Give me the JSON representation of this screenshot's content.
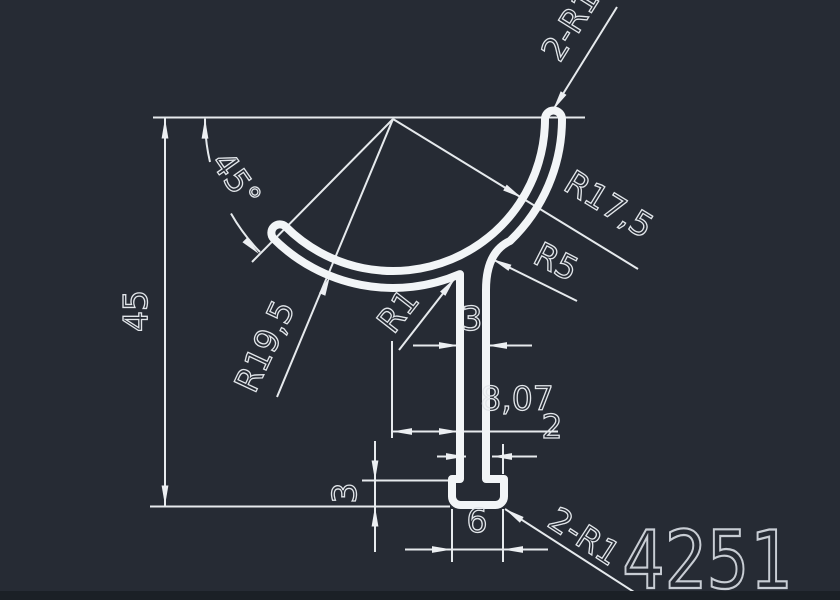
{
  "canvas": {
    "width": 840,
    "height": 600,
    "background_color": "#262b34",
    "footer_strip_color": "#1b2026"
  },
  "style": {
    "profile_color": "#f2f5f7",
    "dimension_color": "#e6eaed",
    "text_color": "#e2e6ea",
    "part_number_color": "#c8cdd4"
  },
  "drawing": {
    "part_number": "4251",
    "labels": {
      "height": "45",
      "angle": "45°",
      "radius_inner": "R17,5",
      "radius_outer": "R19,5",
      "fillet_right": "R5",
      "fillet_left": "R1",
      "top_end_rounds": "2-R1",
      "stem_width": "3",
      "stem_offset": "8,07",
      "foot_right_overhang": "2",
      "foot_height": "3",
      "foot_width": "6",
      "bottom_corner_rounds": "2-R1"
    }
  }
}
